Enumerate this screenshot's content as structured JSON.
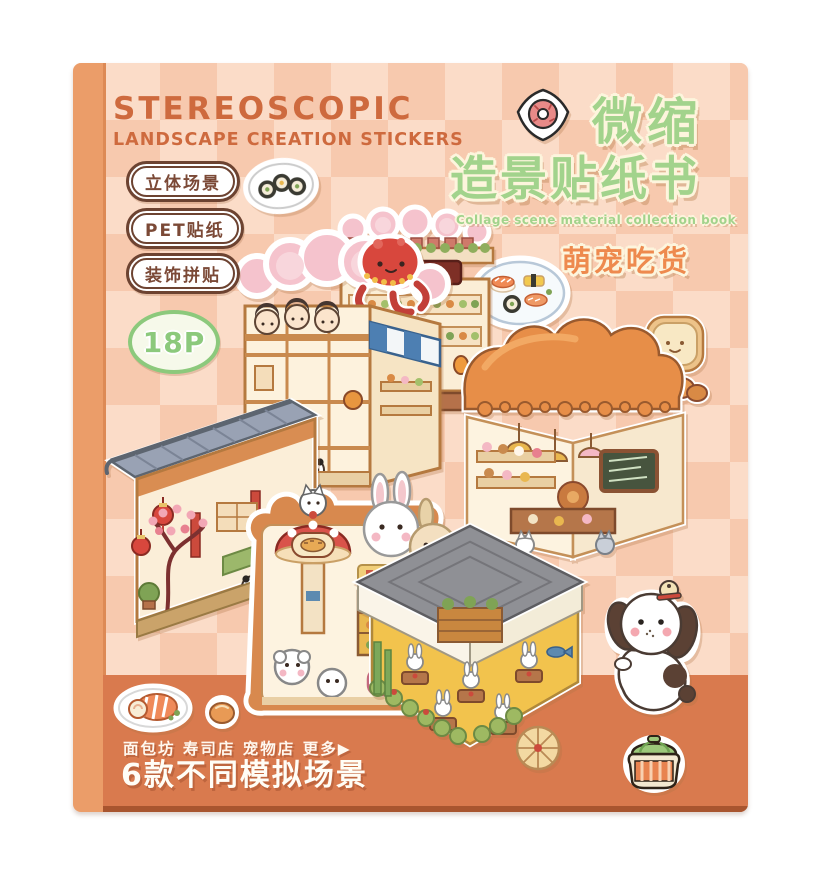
{
  "product": {
    "header": {
      "title_en": "STEREOSCOPIC",
      "subtitle_en": "LANDSCAPE CREATION STICKERS"
    },
    "feature_badges": [
      {
        "label": "立体场景"
      },
      {
        "label": "PET贴纸"
      },
      {
        "label": "装饰拼贴"
      }
    ],
    "page_count_badge": {
      "label": "18P"
    },
    "title_block": {
      "line1_cn": "微缩",
      "line2_cn": "造景贴纸书",
      "subtitle_en": "Collage scene material collection book",
      "theme_badge_cn": "萌宠吃货"
    },
    "footer": {
      "shop_list_cn": "面包坊 寿司店 宠物店 更多▶",
      "tagline_cn": "6款不同模拟场景"
    },
    "scenes": [
      {
        "name": "sushi-izakaya-scene",
        "depicts": "two-story sushi house, red octopus on roof, striped awning, pandas"
      },
      {
        "name": "sushi-market-scene",
        "depicts": "sushi shop front with dark red sign, garland roof and orange lanterns"
      },
      {
        "name": "bakery-scene",
        "depicts": "bakery room with bread-loaf roof, toast sign, croissant and chalkboard"
      },
      {
        "name": "teahouse-scene",
        "depicts": "Chinese teahouse with grey tiled roof, red lanterns and plum tree"
      },
      {
        "name": "pet-shop-scene",
        "depicts": "pet shop with red mushroom kiosk, white cat and rabbit heads"
      },
      {
        "name": "restaurant-scene",
        "depicts": "rabbit restaurant with grey scalloped roof, yellow floor and hedge"
      }
    ],
    "stickers": [
      {
        "name": "maki-plate-sticker"
      },
      {
        "name": "donut-sticker"
      },
      {
        "name": "sushi-platter-sticker"
      },
      {
        "name": "puppy-sticker"
      },
      {
        "name": "jam-jar-sticker"
      },
      {
        "name": "salmon-roll-sticker"
      },
      {
        "name": "bread-bun-sticker"
      }
    ],
    "colors": {
      "spine": "#eb9d69",
      "cover_checker_light": "#fbdcc8",
      "cover_checker_dark": "#f7c9ae",
      "bottom_band": "#d97a4e",
      "band_edge": "#a8552f",
      "heading_orange": "#ce6a3e",
      "title_green": "#a2d38c",
      "badge_brown": "#6d4331",
      "theme_orange": "#ee8a4e",
      "bubble_outline_cream": "#fdf5dd"
    }
  }
}
